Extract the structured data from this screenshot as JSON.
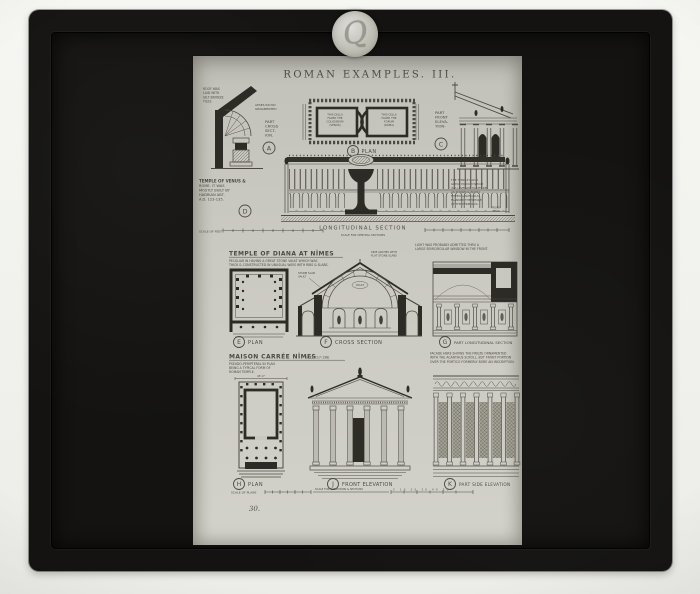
{
  "palette": {
    "bg": "#f2f2ee",
    "frame": "#141311",
    "paper": "#c9c8c0",
    "ink": "#45423a",
    "ink-dark": "#24221c"
  },
  "photo": {
    "sticker_mark": "Q",
    "slide_number": "30."
  },
  "plate": {
    "title": "ROMAN EXAMPLES. III.",
    "venus": {
      "roof_note": [
        "ROOF WAS",
        "LAID WITH",
        "GILT BRONZE",
        "TILES"
      ],
      "apse_note": [
        "APSES RICHLY",
        "ORNAMENTED"
      ],
      "label_a": {
        "letter": "A",
        "lines": [
          "PART",
          "CROSS",
          "SECT-",
          "ION."
        ]
      },
      "label_b": {
        "letter": "B",
        "text": "PLAN"
      },
      "label_c": {
        "letter": "C",
        "lines": [
          "PART",
          "FRONT",
          "ELEVA-",
          "TION-"
        ]
      },
      "label_d": {
        "letter": "D"
      },
      "heading": [
        "TEMPLE OF VENUS &",
        "ROME. IT WAS",
        "MOSTLY BUILT BY",
        "HADRIAN ABT.",
        "A.D. 123-135."
      ],
      "cella_left": [
        "THIS CELLA",
        "FACED THE",
        "COLOSSEUM",
        "(VENUS)"
      ],
      "cella_right": [
        "THIS CELLA",
        "FACED THE",
        "FORUM",
        "(ROMA)"
      ],
      "side_note": [
        "THE TEMPLE HAD A",
        "GREAT PODIUM WHICH",
        "IS A LEVELLED PLATFORM",
        "AS SHOWN & RICHLY",
        "FITTED GIANT COLS.",
        "FLANKED THE WHOLE",
        "OF THE PERIBOLUS."
      ],
      "stair_note": [
        "FRONT",
        "STAIR"
      ],
      "section_label": "LONGITUDINAL SECTION",
      "scale_feet": "SCALE OF FEET",
      "scale_sections": "SCALE FOR CENTRAL SECTIONS"
    },
    "diana": {
      "heading": "TEMPLE OF DIANA AT NÎMES",
      "sub_note": [
        "PECULIAR IN HAVING A GREAT STONE VAULT WHICH WAS",
        "THICK & CONSTRUCTED IN UNUSUAL WAYS WITH RIBS & SLABS."
      ],
      "side_note": [
        "LIGHT WAS PROBABLY ADMITTED THRU A",
        "LARGE SEMICIRCULAR WINDOW IN THE FRONT."
      ],
      "vault_note": [
        "STONE SLAB",
        "VAULT"
      ],
      "arch_note": [
        "SIDE ARCHES WITH",
        "FLAT STONE SLABS"
      ],
      "vault_label": "VAULT",
      "label_e": {
        "letter": "E",
        "text": "PLAN"
      },
      "label_f": {
        "letter": "F",
        "text": "CROSS SECTION"
      },
      "label_g": {
        "letter": "G",
        "text": "PART LONGITUDINAL SECTION"
      }
    },
    "maison": {
      "heading": "MAISON CARRÉE NÎMES",
      "heading_date": "(A.D. 117-138)",
      "sub_note": [
        "PSEUDO-PERIPTERAL IN PLAN",
        "BEING A TYPICAL FORM OF",
        "ROMAN TEMPLE."
      ],
      "dim": "45'-0\"",
      "side_note": [
        "FACADE HERE SHOWS THE FRIEZE ORNAMENTED",
        "WITH THE ACANTHUS SCROLL. BUT FRONT PORTION",
        "OVER THE PORTICO FORMERLY BORE AN INSCRIPTION."
      ],
      "label_h": {
        "letter": "H",
        "text": "PLAN"
      },
      "label_j": {
        "letter": "J",
        "text": "FRONT ELEVATION"
      },
      "label_k": {
        "letter": "K",
        "text": "PART SIDE ELEVATION"
      },
      "scale_plans": "SCALE OF PLANS",
      "scale_elevations": "SCALE FOR ELEVATIONS & SECTIONS",
      "scale_numbers": "5 10 20 30 40 50"
    }
  }
}
